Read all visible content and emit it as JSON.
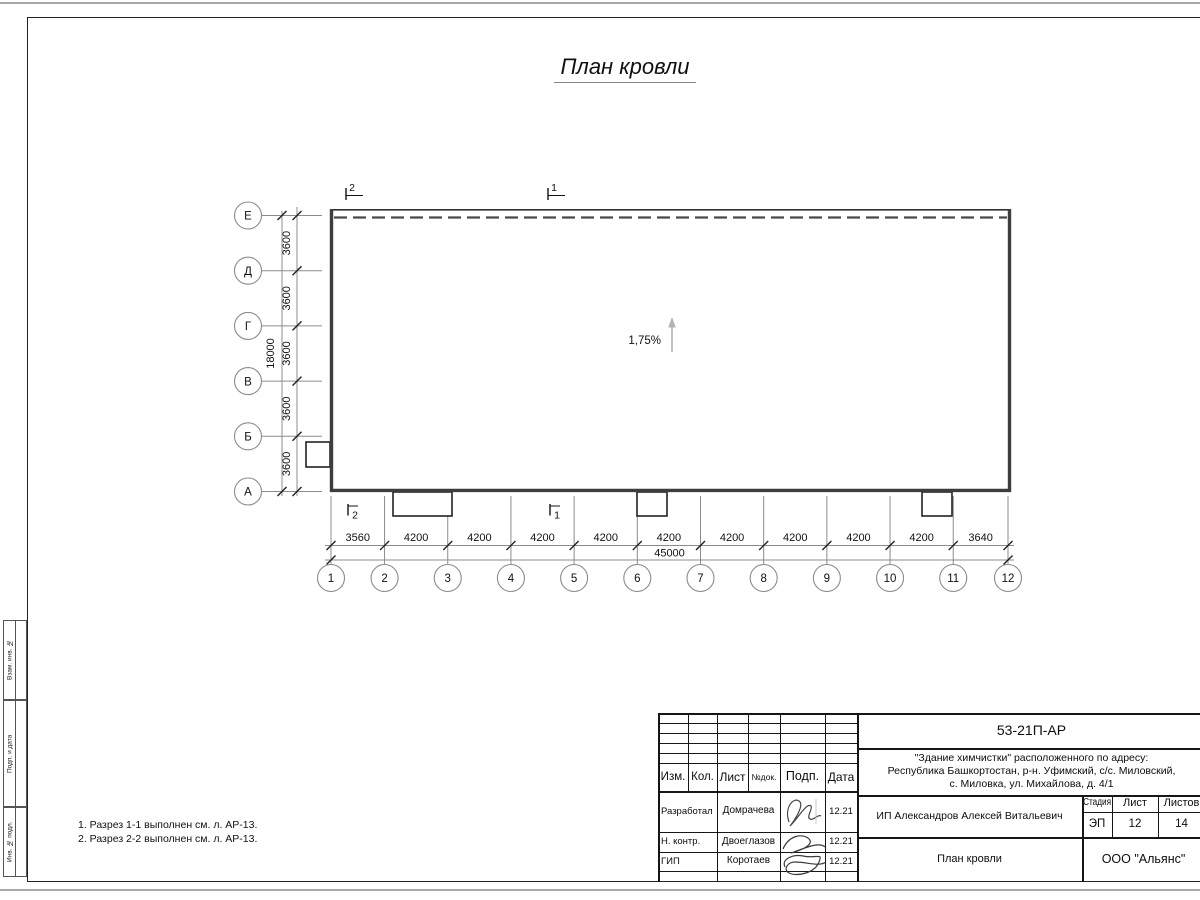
{
  "drawing": {
    "title": "План кровли",
    "slope_label": "1,75%",
    "notes": [
      "1. Разрез 1-1 выполнен см. л. АР-13.",
      "2. Разрез 2-2 выполнен см. л. АР-13."
    ],
    "plan": {
      "vertical_axes": [
        "1",
        "2",
        "3",
        "4",
        "5",
        "6",
        "7",
        "8",
        "9",
        "10",
        "11",
        "12"
      ],
      "horizontal_axes_bottom_up": [
        "А",
        "Б",
        "В",
        "Г",
        "Д",
        "Е"
      ],
      "bottom_dims": [
        "3560",
        "4200",
        "4200",
        "4200",
        "4200",
        "4200",
        "4200",
        "4200",
        "4200",
        "4200",
        "3640"
      ],
      "bottom_total": "45000",
      "left_dims": [
        "3600",
        "3600",
        "3600",
        "3600",
        "3600"
      ],
      "left_total": "18000",
      "section_marks": [
        "2",
        "1"
      ]
    },
    "colors": {
      "wall": "#3d3d3d",
      "dim_line": "#8c8c8c",
      "slope_arrow": "#b3b3b3",
      "text": "#111111"
    }
  },
  "frame_column": {
    "labels": [
      "Взам. инв. №",
      "Подп. и дата",
      "Инв. № подл."
    ]
  },
  "title_block": {
    "doc_number": "53-21П-АР",
    "project_lines": [
      "\"Здание химчистки\" расположенного по адресу:",
      "Республика Башкортостан, р-н. Уфимский, с/с. Миловский,",
      "с. Миловка, ул. Михайлова, д. 4/1"
    ],
    "client": "ИП Александров Алексей Витальевич",
    "sheet_name": "План кровли",
    "company": "ООО \"Альянс\"",
    "header_cells": [
      "Изм.",
      "Кол.",
      "Лист",
      "№док.",
      "Подп.",
      "Дата"
    ],
    "stage_header": [
      "Стадия",
      "Лист",
      "Листов"
    ],
    "stage_values": [
      "ЭП",
      "12",
      "14"
    ],
    "sign_rows": [
      {
        "role": "Разработал",
        "name": "Домрачева",
        "date": "12.21"
      },
      {
        "role": "Н. контр.",
        "name": "Двоеглазов",
        "date": "12.21"
      },
      {
        "role": "ГИП",
        "name": "Коротаев",
        "date": "12.21"
      }
    ]
  }
}
